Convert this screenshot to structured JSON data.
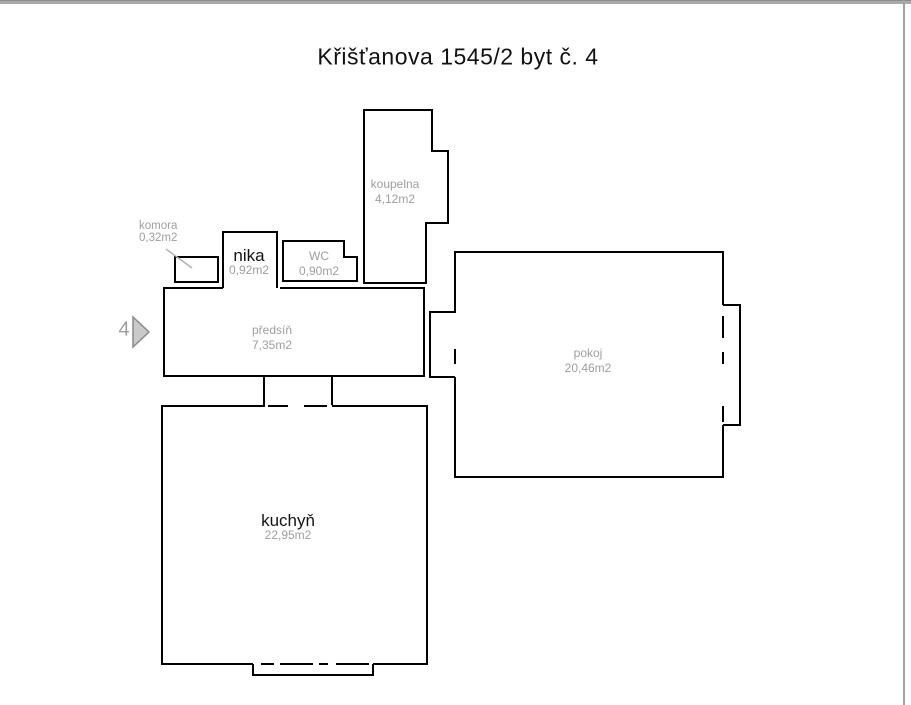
{
  "header": {
    "title": "Křišťanova 1545/2 byt č. 4"
  },
  "unit_marker": {
    "number": "4"
  },
  "rooms": {
    "komora": {
      "name": "komora",
      "area": "0,32m2"
    },
    "nika": {
      "name": "nika",
      "area": "0,92m2"
    },
    "wc": {
      "name": "WC",
      "area": "0,90m2"
    },
    "koupelna": {
      "name": "koupelna",
      "area": "4,12m2"
    },
    "predsin": {
      "name": "předsíň",
      "area": "7,35m2"
    },
    "pokoj": {
      "name": "pokoj",
      "area": "20,46m2"
    },
    "kuchyn": {
      "name": "kuchyň",
      "area": "22,95m2"
    }
  },
  "colors": {
    "wall": "#000000",
    "label_gray": "#9e9e9e",
    "label_black": "#141414",
    "edge_bar_gray": "#a9a9a9",
    "marker_fill": "#c9c9c9",
    "marker_stroke": "#8a8a8a"
  }
}
